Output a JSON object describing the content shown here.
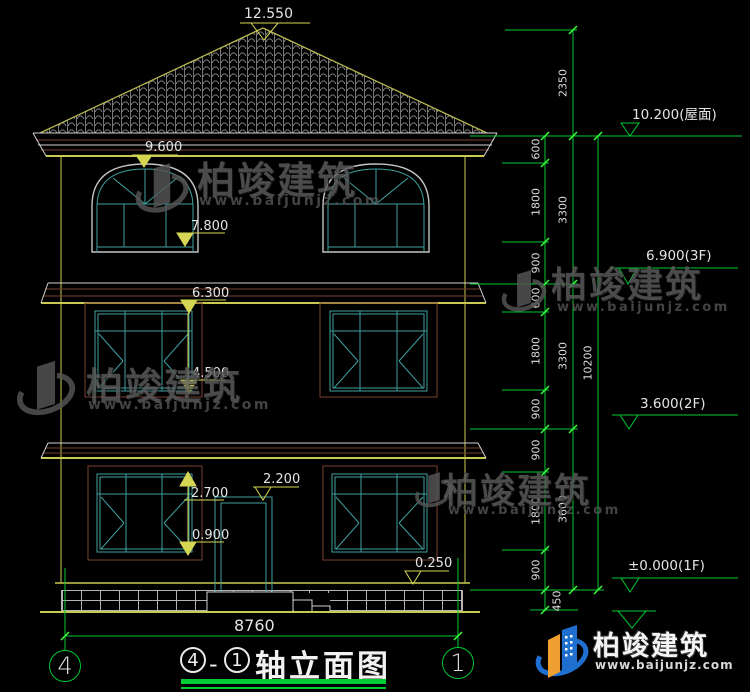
{
  "watermark": {
    "brand": "柏竣建筑",
    "url": "www.baijunjz.com"
  },
  "elevation_labels": {
    "peak": "12.550",
    "eave": "9.600",
    "window3_top": "7.800",
    "belt": "6.300",
    "window2_top": "4.500",
    "window1_top": "2.700",
    "window1_sill": "0.900",
    "door_top": "2.200",
    "plinth": "0.250"
  },
  "overall_width": "8760",
  "right_dims": {
    "tier1": [
      "600",
      "1800",
      "900",
      "600",
      "1800",
      "900",
      "900",
      "1800",
      "900",
      "450"
    ],
    "tier2": [
      "2350",
      "3300",
      "3300",
      "3600"
    ],
    "tier3": [
      "10200"
    ],
    "elevations": [
      "10.200(屋面)",
      "6.900(3F)",
      "3.600(2F)",
      "±0.000(1F)"
    ]
  },
  "axes": {
    "left": "4",
    "right": "1"
  },
  "title": {
    "bubble_left": "4",
    "separator": "-",
    "bubble_right": "1",
    "text": "轴立面图"
  }
}
